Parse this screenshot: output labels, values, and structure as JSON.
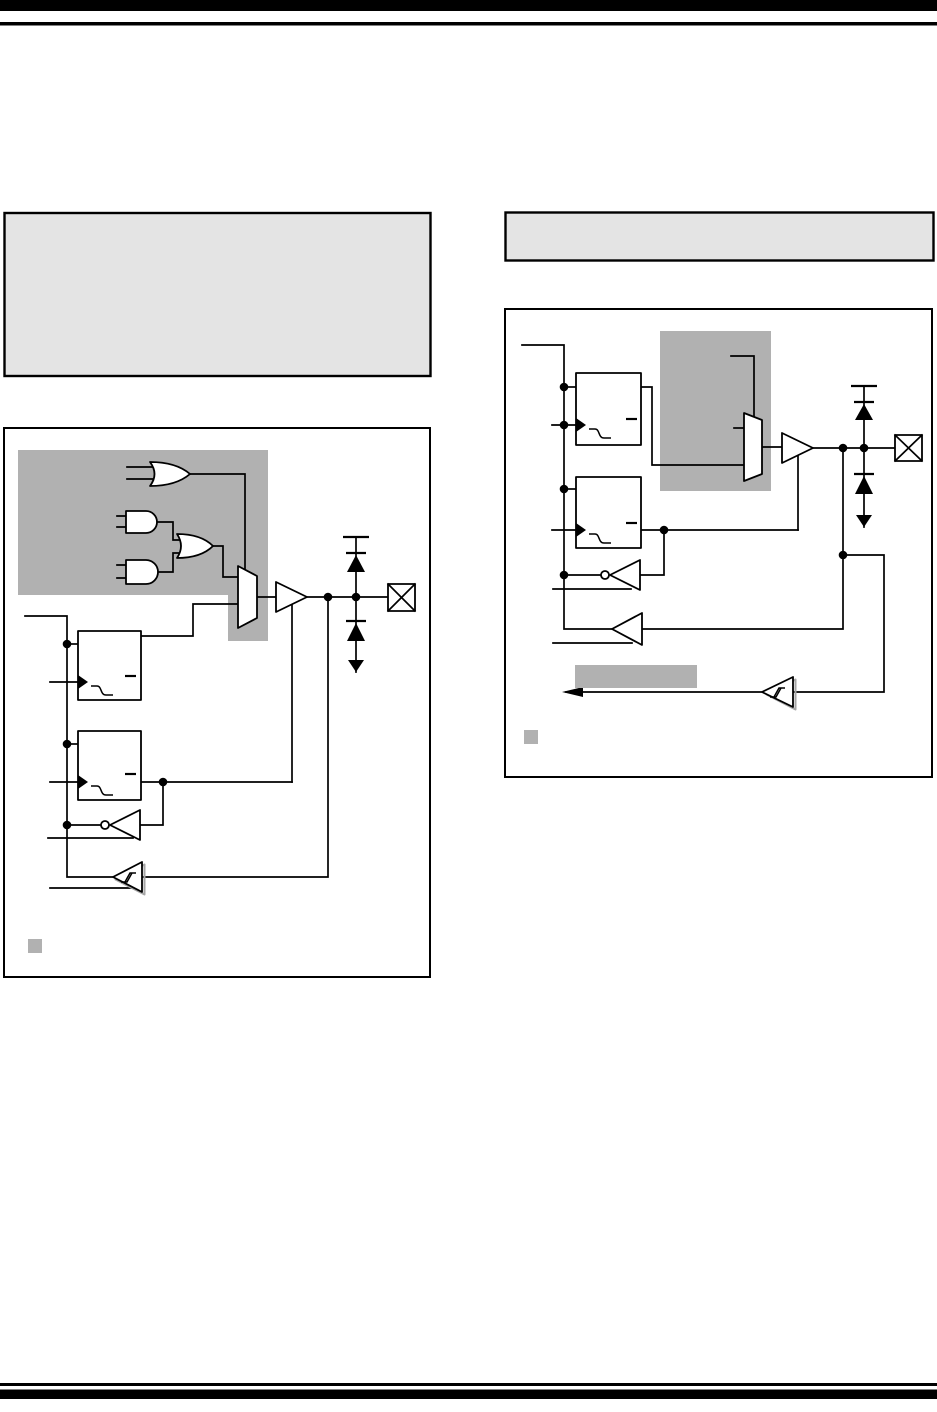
{
  "page": {
    "width": 937,
    "height": 1412,
    "background": "#ffffff",
    "top_rules": [
      "thick-bar",
      "thin-rule"
    ],
    "bottom_rules": [
      "thin-rule",
      "thick-bar"
    ]
  },
  "colors": {
    "page_bg": "#ffffff",
    "rule": "#000000",
    "line": "#000000",
    "white": "#ffffff",
    "header_fill": "#e4e4e4",
    "header_border": "#000000",
    "shade": "#b1b1b1",
    "note_marker": "#b1b1b1",
    "highlight": "#b1b1b1",
    "shadow": "#a6a6a6"
  },
  "header_boxes": [
    {
      "id": "left",
      "content": ""
    },
    {
      "id": "right",
      "content": ""
    }
  ],
  "figures": [
    {
      "id": "figure-left",
      "shaded_region": true,
      "note_marker": true,
      "components": [
        "or-gate",
        "and-gate",
        "and-gate",
        "or-gate",
        "mux",
        "tristate-buffer",
        "data-latch",
        "tris-latch",
        "inverting-buffer",
        "schmitt-trigger-buffer",
        "vdd-protection-diode",
        "vss-protection-diode",
        "io-pad"
      ]
    },
    {
      "id": "figure-right",
      "shaded_region": true,
      "note_marker": true,
      "highlight_bar": true,
      "components": [
        "mux",
        "tristate-buffer",
        "data-latch",
        "tris-latch",
        "inverting-buffer",
        "buffer",
        "schmitt-trigger-buffer",
        "vdd-protection-diode",
        "vss-protection-diode",
        "io-pad",
        "bus-arrow"
      ]
    }
  ]
}
